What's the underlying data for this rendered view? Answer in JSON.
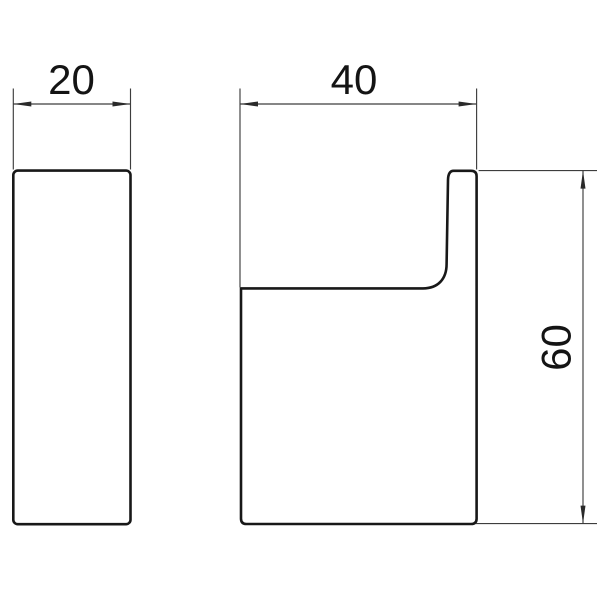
{
  "page": {
    "background": "#ffffff",
    "description": "Technical line drawing of a wall hook shown in two orthographic views with three dimensions"
  },
  "drawing": {
    "colors": {
      "outline": "#181818",
      "dimension_lines": "#3d3d3d",
      "arrows": "#2a2a2a",
      "text": "#141414",
      "background": "#ffffff"
    },
    "views": [
      {
        "name": "front-view",
        "description": "Front view: tall narrow rounded rectangle"
      },
      {
        "name": "side-view",
        "description": "Side profile view: body with upward hook lip"
      }
    ],
    "dimensions": [
      {
        "name": "front-width",
        "value": "20",
        "orientation": "horizontal",
        "view": "front-view"
      },
      {
        "name": "side-depth",
        "value": "40",
        "orientation": "horizontal",
        "view": "side-view"
      },
      {
        "name": "side-height",
        "value": "60",
        "orientation": "vertical",
        "view": "side-view"
      }
    ]
  }
}
